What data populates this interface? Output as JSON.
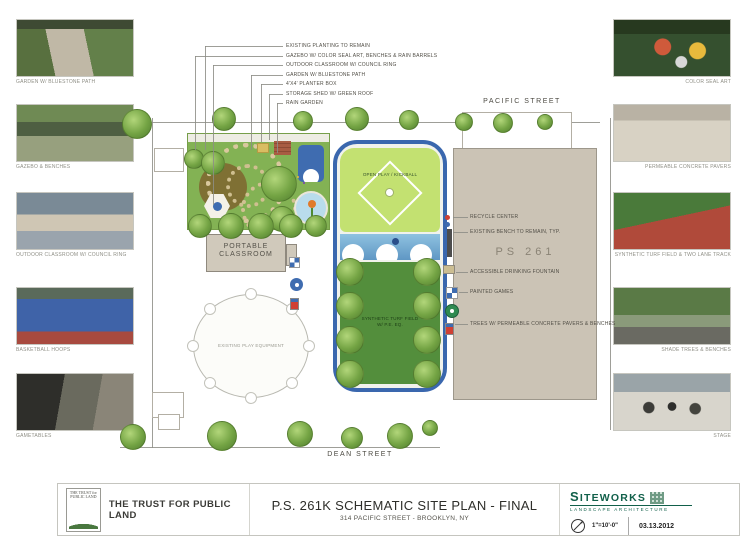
{
  "streets": {
    "top": "PACIFIC STREET",
    "bottom": "DEAN STREET"
  },
  "plan": {
    "open_play": "OPEN PLAY / KICKBALL",
    "turf_line1": "SYNTHETIC TURF FIELD",
    "turf_line2": "W/ P.E. EQ.",
    "portable_line1": "PORTABLE",
    "portable_line2": "CLASSROOM",
    "existing_play": "EXISTING PLAY EQUIPMENT",
    "school": "PS 261"
  },
  "top_callouts": [
    "EXISTING PLANTING TO REMAIN",
    "GAZEBO W/ COLOR SEAL ART, BENCHES & RAIN BARRELS",
    "OUTDOOR CLASSROOM W/ COUNCIL RING",
    "GARDEN W/ BLUESTONE PATH",
    "4'X4' PLANTER BOX",
    "STORAGE SHED W/ GREEN ROOF",
    "RAIN GARDEN"
  ],
  "right_callouts": [
    "RECYCLE CENTER",
    "EXISTING BENCH TO REMAIN, TYP.",
    "ACCESSIBLE DRINKING FOUNTAIN",
    "PAINTED GAMES",
    "TREES W/ PERMEABLE CONCRETE PAVERS & BENCHES"
  ],
  "left_photos": [
    {
      "caption": "GARDEN W/ BLUESTONE PATH"
    },
    {
      "caption": "GAZEBO & BENCHES"
    },
    {
      "caption": "OUTDOOR CLASSROOM W/ COUNCIL RING"
    },
    {
      "caption": "BASKETBALL HOOPS"
    },
    {
      "caption": "GAMETABLES"
    }
  ],
  "right_photos": [
    {
      "caption": "COLOR SEAL ART"
    },
    {
      "caption": "PERMEABLE CONCRETE PAVERS"
    },
    {
      "caption": "SYNTHETIC TURF FIELD & TWO LANE TRACK"
    },
    {
      "caption": "SHADE TREES & BENCHES"
    },
    {
      "caption": "STAGE"
    }
  ],
  "titleblock": {
    "client": "THE TRUST FOR PUBLIC LAND",
    "logo_text": "THE TRUST for PUBLIC LAND",
    "title": "P.S. 261K SCHEMATIC SITE PLAN - FINAL",
    "subtitle": "314 PACIFIC STREET - BROOKLYN, NY",
    "firm_name": "SITEWORKS",
    "firm_sub": "LANDSCAPE ARCHITECTURE",
    "scale": "1\"=10'-0\"",
    "date": "03.13.2012"
  },
  "colors": {
    "track_blue": "#3a67ae",
    "turf_green": "#538e3c",
    "open_play_green": "#c3e171",
    "building_tan": "#cbc3b5",
    "garden_green": "#83b254",
    "siteworks_green": "#11604a",
    "tpl_green": "#49773f"
  }
}
